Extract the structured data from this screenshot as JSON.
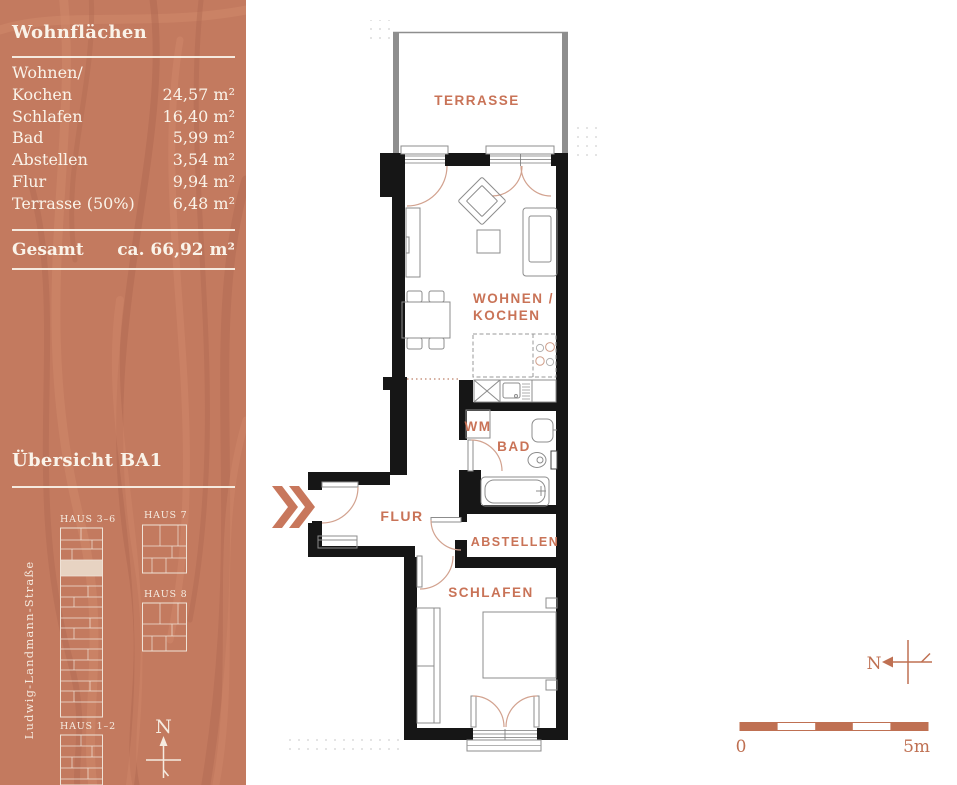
{
  "colors": {
    "sidebar_bg": "#c37a5f",
    "accent": "#c97357",
    "wall": "#161616",
    "sidebar_text": "#faf3e9",
    "scale_accent": "#bf7052"
  },
  "sidebar": {
    "title": "Wohnflächen",
    "rows": [
      {
        "label": "Wohnen/",
        "value": ""
      },
      {
        "label": "Kochen",
        "value": "24,57 m²"
      },
      {
        "label": "Schlafen",
        "value": "16,40 m²"
      },
      {
        "label": "Bad",
        "value": "5,99 m²"
      },
      {
        "label": "Abstellen",
        "value": "3,54 m²"
      },
      {
        "label": "Flur",
        "value": "9,94 m²"
      },
      {
        "label": "Terrasse (50%)",
        "value": "6,48 m²"
      }
    ],
    "total": {
      "label": "Gesamt",
      "value": "ca. 66,92 m²"
    },
    "overview_title": "Übersicht BA1",
    "street": "Ludwig-Landmann-Straße",
    "buildings": {
      "b36": "HAUS 3–6",
      "b7": "HAUS 7",
      "b8": "HAUS 8",
      "b12": "HAUS 1–2"
    },
    "north": "N"
  },
  "plan": {
    "labels": {
      "terrasse": "TERRASSE",
      "wohnen1": "WOHNEN /",
      "wohnen2": "KOCHEN",
      "wm": "WM",
      "bad": "BAD",
      "flur": "FLUR",
      "abstellen": "ABSTELLEN",
      "schlafen": "SCHLAFEN"
    },
    "compass": "N",
    "scale": {
      "start": "0",
      "end": "5m"
    }
  }
}
